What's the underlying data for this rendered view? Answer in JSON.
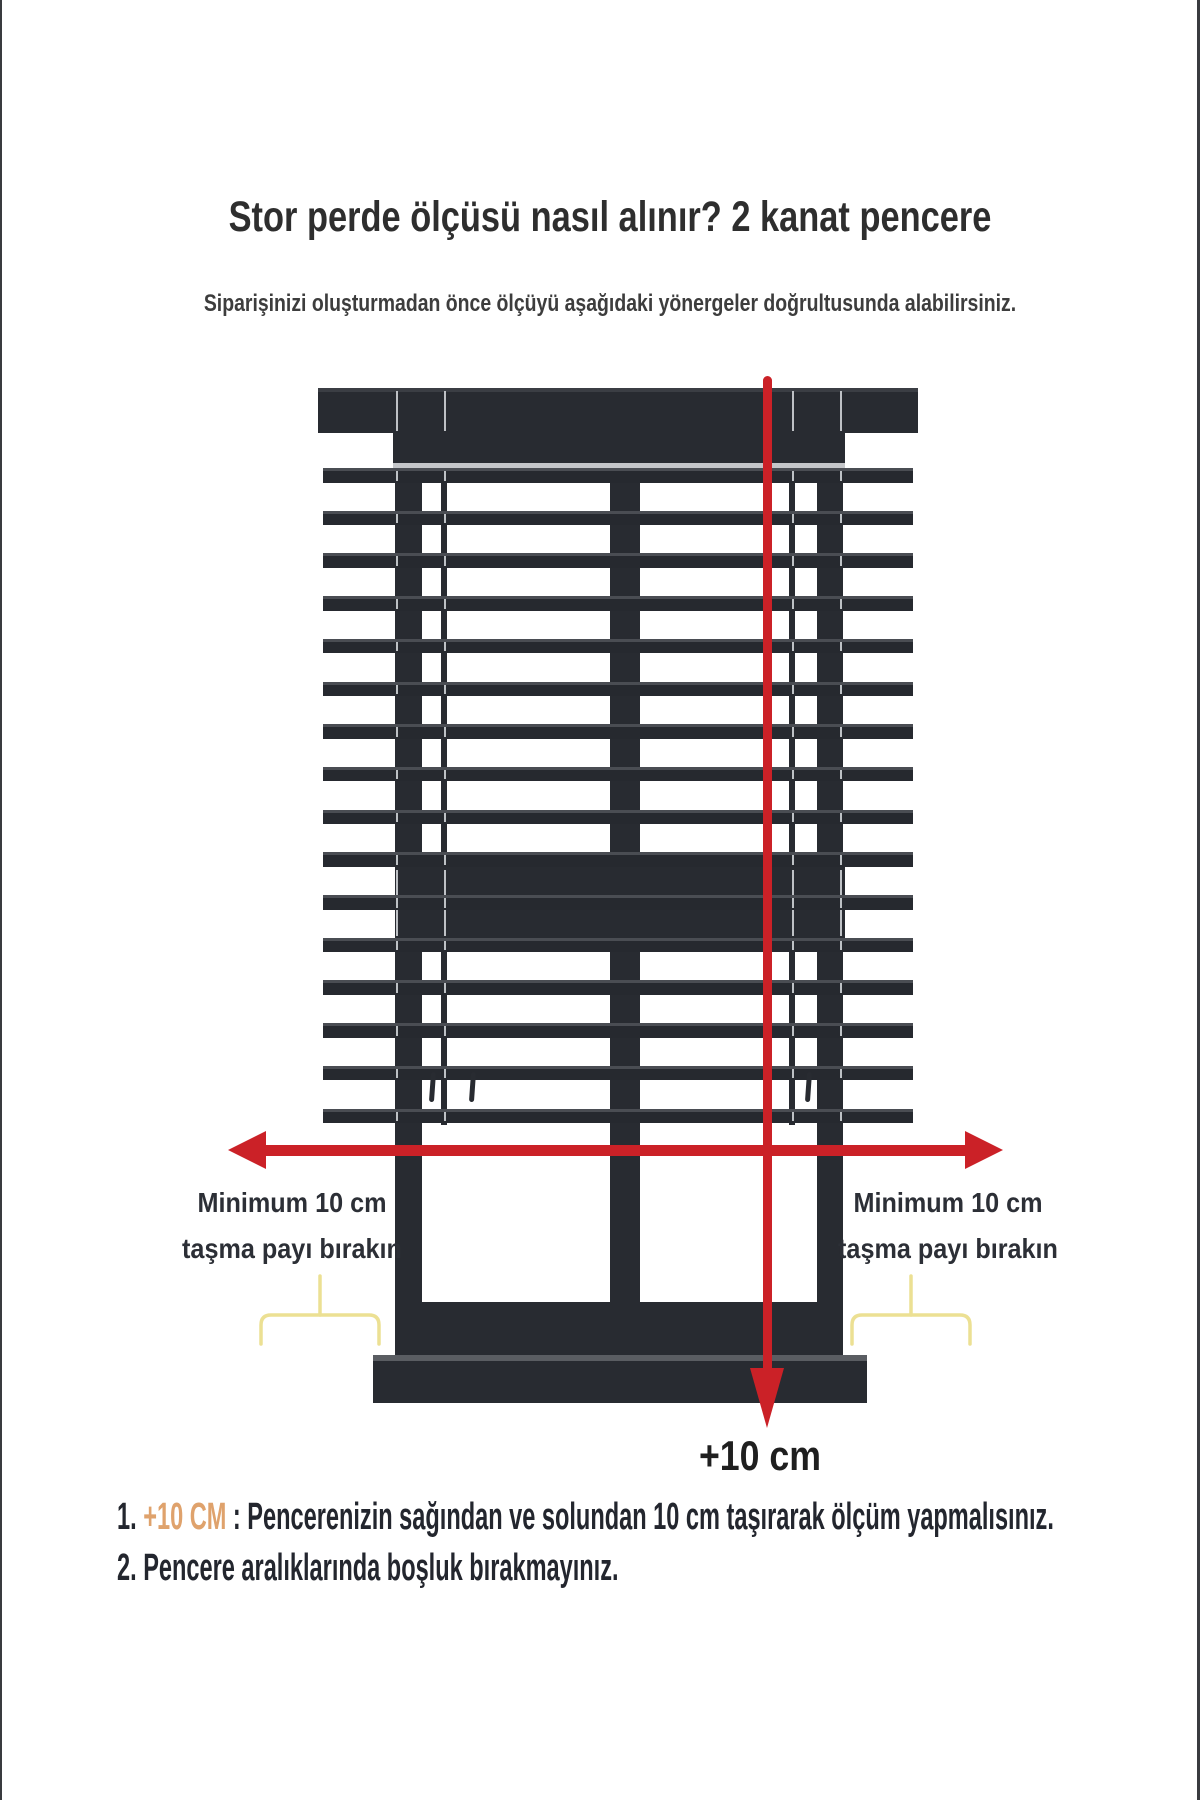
{
  "page": {
    "title": "Stor perde ölçüsü nasıl alınır? 2 kanat pencere",
    "subtitle": "Siparişinizi oluşturmadan önce ölçüyü aşağıdaki yönergeler doğrultusunda alabilirsiniz."
  },
  "theme": {
    "accent_red": "#cb2127",
    "frame_dark": "#282b31",
    "brace_yellow": "#ece093",
    "highlight_orange": "#dfa26c",
    "text_dark": "#23262e"
  },
  "diagram": {
    "overhang_left": {
      "line1": "Minimum 10 cm",
      "line2": "taşma payı bırakın"
    },
    "overhang_right": {
      "line1": "Minimum 10 cm",
      "line2": "taşma payı bırakın"
    },
    "bottom_measurement": "+10 cm"
  },
  "notes": [
    {
      "number": "1.",
      "highlight": " +10 CM",
      "text": " : Pencerenizin sağından ve solundan 10 cm taşırarak ölçüm yapmalısınız."
    },
    {
      "number": "2.",
      "highlight": "",
      "text": " Pencere aralıklarında boşluk bırakmayınız."
    }
  ]
}
